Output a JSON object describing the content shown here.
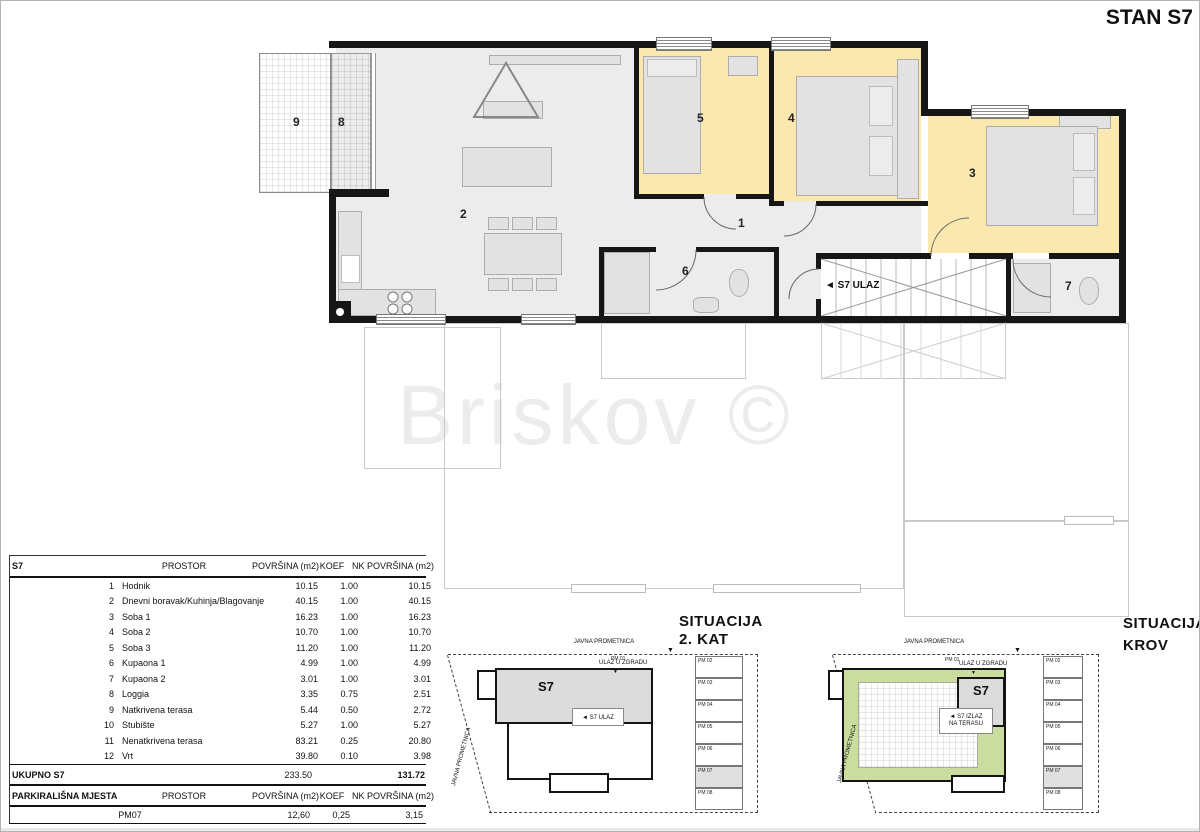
{
  "title": "STAN S7",
  "watermark": "Briskov ©",
  "floor_plan": {
    "room_labels": {
      "hallway": "1",
      "living": "2",
      "room1": "3",
      "room2": "4",
      "room3": "5",
      "bath1": "6",
      "bath2": "7",
      "loggia": "8",
      "terrace": "9"
    },
    "entrance_label": "◄ S7 ULAZ"
  },
  "area_table": {
    "unit_label": "S7",
    "col_prostor": "PROSTOR",
    "col_povrsina": "POVRŠINA (m2)",
    "col_koef": "KOEF",
    "col_nk": "NK POVRŠINA (m2)",
    "rows": [
      {
        "no": "1",
        "name": "Hodnik",
        "area": "10.15",
        "koef": "1.00",
        "nk": "10.15"
      },
      {
        "no": "2",
        "name": "Dnevni boravak/Kuhinja/Blagovanje",
        "area": "40.15",
        "koef": "1.00",
        "nk": "40.15"
      },
      {
        "no": "3",
        "name": "Soba 1",
        "area": "16.23",
        "koef": "1.00",
        "nk": "16.23"
      },
      {
        "no": "4",
        "name": "Soba 2",
        "area": "10.70",
        "koef": "1.00",
        "nk": "10.70"
      },
      {
        "no": "5",
        "name": "Soba 3",
        "area": "11.20",
        "koef": "1.00",
        "nk": "11.20"
      },
      {
        "no": "6",
        "name": "Kupaona 1",
        "area": "4.99",
        "koef": "1.00",
        "nk": "4.99"
      },
      {
        "no": "7",
        "name": "Kupaona 2",
        "area": "3.01",
        "koef": "1.00",
        "nk": "3.01"
      },
      {
        "no": "8",
        "name": "Loggia",
        "area": "3.35",
        "koef": "0.75",
        "nk": "2.51"
      },
      {
        "no": "9",
        "name": "Natkrivena terasa",
        "area": "5.44",
        "koef": "0.50",
        "nk": "2.72"
      },
      {
        "no": "10",
        "name": "Stubište",
        "area": "5.27",
        "koef": "1.00",
        "nk": "5.27"
      },
      {
        "no": "11",
        "name": "Nenatkrivena terasa",
        "area": "83.21",
        "koef": "0.25",
        "nk": "20.80"
      },
      {
        "no": "12",
        "name": "Vrt",
        "area": "39.80",
        "koef": "0.10",
        "nk": "3.98"
      }
    ],
    "total_label": "UKUPNO S7",
    "total_area": "233.50",
    "total_nk": "131.72"
  },
  "parking_table": {
    "title": "PARKIRALIŠNA MJESTA",
    "col_prostor": "PROSTOR",
    "col_povrsina": "POVRŠINA (m2)",
    "col_koef": "KOEF",
    "col_nk": "NK POVRŠINA (m2)",
    "rows": [
      {
        "name": "PM07",
        "area": "12,60",
        "koef": "0,25",
        "nk": "3,15"
      }
    ]
  },
  "situation_kat": {
    "title_line1": "SITUACIJA",
    "title_line2": "2. KAT",
    "road_top": "JAVNA PROMETNICA",
    "road_side": "JAVNA PROMETNICA",
    "pm01": "PM 01",
    "arrow_down": "▼",
    "building_entrance": "ULAZ U ZGRADU",
    "unit_label": "S7",
    "unit_entrance": "◄ S7 ULAZ",
    "parking_stalls": [
      "PM 02",
      "PM 03",
      "PM 04",
      "PM 05",
      "PM 06",
      "PM 07",
      "PM 08"
    ],
    "highlighted_stall": "PM 07"
  },
  "situation_krov": {
    "title_line1": "SITUACIJA",
    "title_line2": "KROV",
    "road_top": "JAVNA PROMETNICA",
    "road_side": "JAVNA PROMETNICA",
    "pm01": "PM 01",
    "arrow_down": "▼",
    "building_entrance": "ULAZ U ZGRADU",
    "unit_label": "S7",
    "unit_exit_line1": "◄ S7 IZLAZ",
    "unit_exit_line2": "NA TERASU",
    "parking_stalls": [
      "PM 02",
      "PM 03",
      "PM 04",
      "PM 05",
      "PM 06",
      "PM 07",
      "PM 08"
    ],
    "highlighted_stall": "PM 07"
  },
  "colors": {
    "room_fill": "#FAE8AF",
    "floor_fill": "#ECECEC",
    "wall": "#161616",
    "terrace_green": "#CBDC9F",
    "stall_highlight": "#E0E0E0"
  }
}
